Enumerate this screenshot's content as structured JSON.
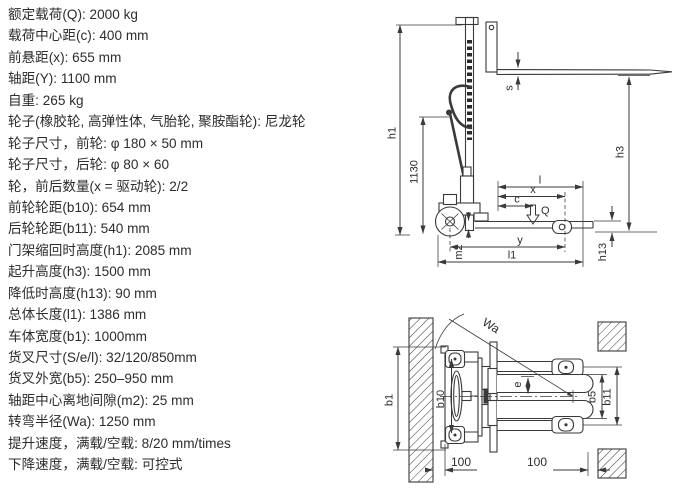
{
  "page": {
    "background": "#ffffff",
    "ink": "#3a3a3a"
  },
  "specs": [
    "额定载荷(Q): 2000 kg",
    "载荷中心距(c): 400 mm",
    "前悬距(x): 655 mm",
    "轴距(Y): 1100 mm",
    "自重: 265 kg",
    "轮子(橡胶轮, 高弹性体, 气胎轮, 聚胺酯轮): 尼龙轮",
    "轮子尺寸，前轮: φ 180 × 50 mm",
    "轮子尺寸，后轮: φ 80 × 60",
    "轮，前后数量(x = 驱动轮): 2/2",
    "前轮轮距(b10): 654 mm",
    "后轮轮距(b11): 540 mm",
    "门架缩回时高度(h1): 2085 mm",
    "起升高度(h3): 1500 mm",
    "降低时高度(h13): 90 mm",
    "总体长度(l1): 1386 mm",
    "车体宽度(b1): 1000mm",
    "货叉尺寸(S/e/l): 32/120/850mm",
    "货叉外宽(b5): 250–950 mm",
    "轴距中心离地间隙(m2): 25 mm",
    "转弯半径(Wa): 1250 mm",
    "提升速度，满载/空载: 8/20 mm/times",
    "下降速度，满载/空载: 可控式"
  ],
  "side_view": {
    "h1": "h1",
    "dim_1130": "1130",
    "s": "s",
    "h3": "h3",
    "l": "l",
    "x": "x",
    "c": "c",
    "q": "Q",
    "m2": "m2",
    "y": "y",
    "l1": "l1",
    "h13": "h13"
  },
  "top_view": {
    "wa": "Wa",
    "b1": "b1",
    "b10": "b10",
    "e": "e",
    "b5": "b5",
    "b11": "b11",
    "clearance_left": "100",
    "clearance_right": "100"
  }
}
